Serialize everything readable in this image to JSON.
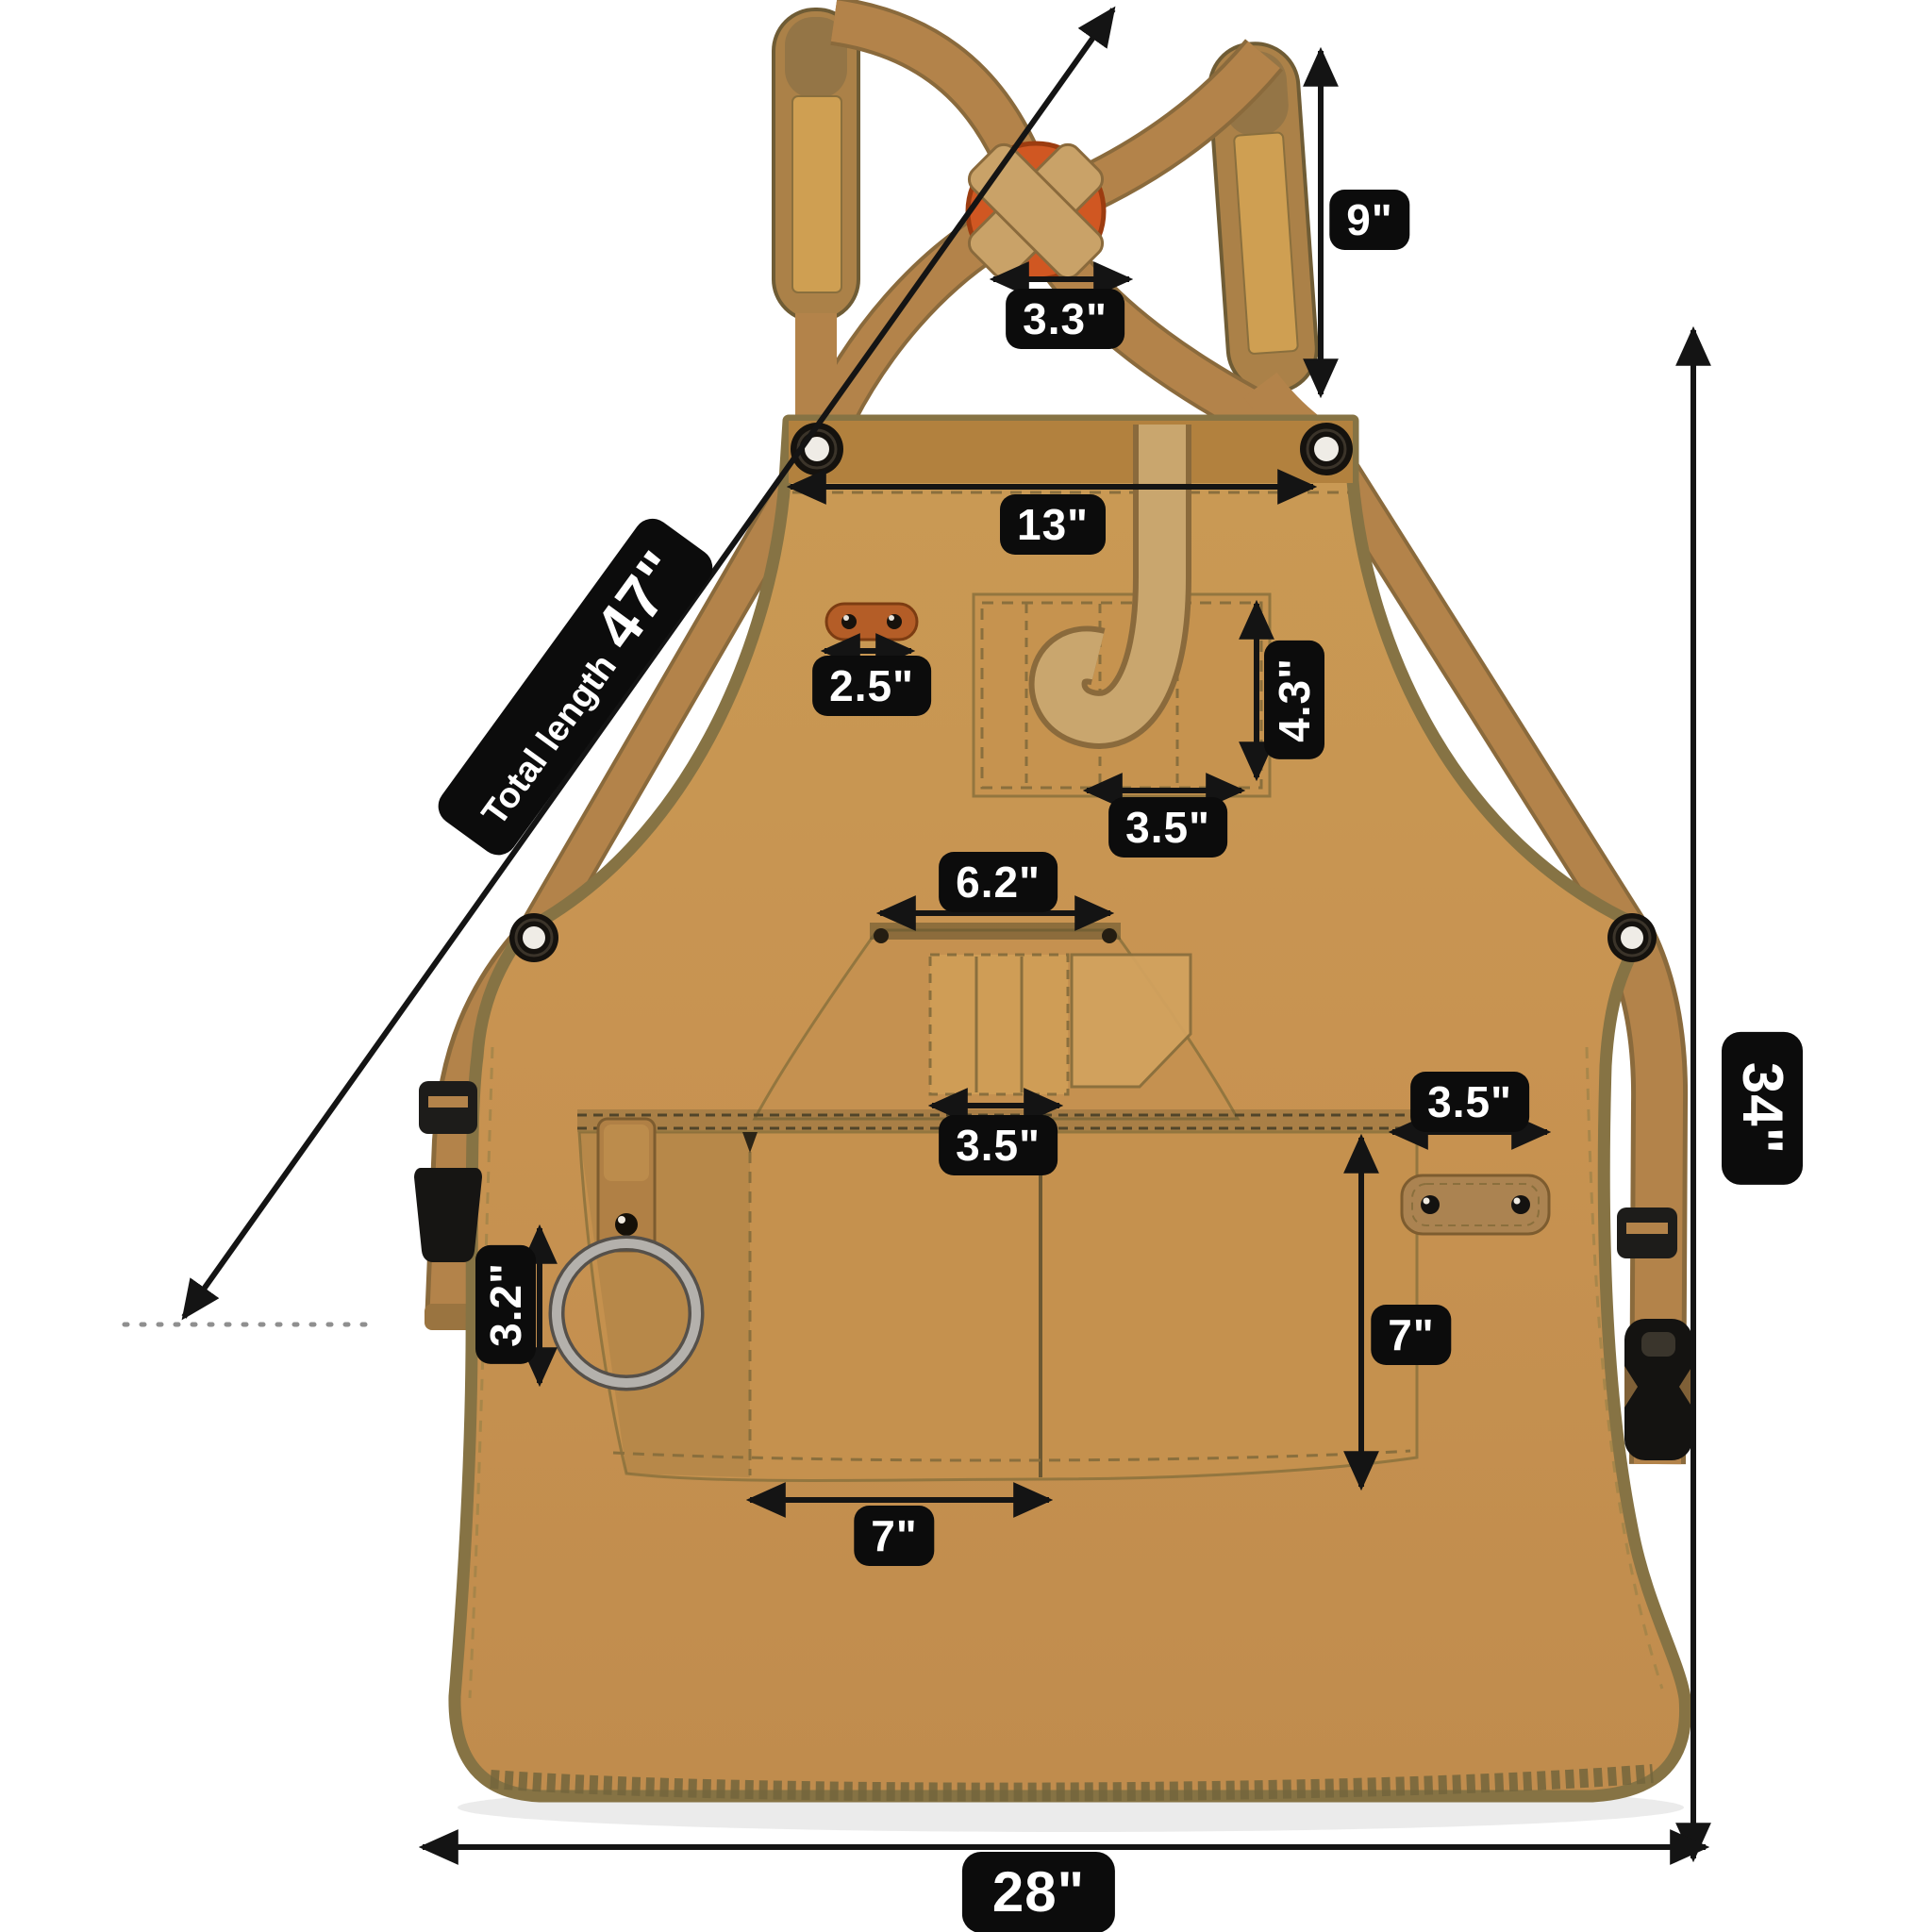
{
  "title": "Canvas work apron size diagram",
  "colors": {
    "background": "#ffffff",
    "apron_canvas": "#c89351",
    "edge_binding": "#867344",
    "strap_webbing": "#b3834a",
    "logo_button": "#d05722",
    "label_background": "#0c0c0c",
    "label_text": "#ffffff",
    "arrow": "#141414"
  },
  "dimensions": {
    "strap_pad_length": "9\"",
    "strap_cross_width": "3.3\"",
    "bib_width": "13\"",
    "total_length_prefix": "Total length",
    "total_length_value": "47\"",
    "chest_patch_width": "2.5\"",
    "chest_pocket_height": "4.3\"",
    "chest_pocket_width": "3.5\"",
    "middle_pocket_width": "6.2\"",
    "pen_slot_width": "3.5\"",
    "side_patch_width": "3.5\"",
    "tool_ring_height": "3.2\"",
    "main_pocket_depth": "7\"",
    "main_pocket_width": "7\"",
    "apron_length": "34\"",
    "apron_width": "28\""
  }
}
